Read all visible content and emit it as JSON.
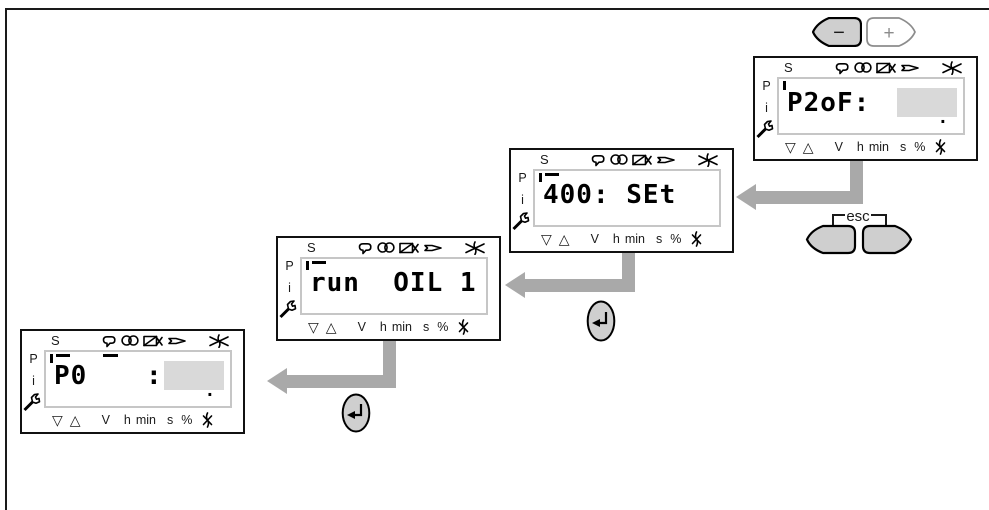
{
  "figure": {
    "kind": "lcd-menu-navigation-sequence"
  },
  "buttons": {
    "minus_label": "−",
    "plus_label": "+",
    "esc_label": "esc",
    "enter_icon_name": "enter-arrow-icon"
  },
  "panel_common": {
    "s_label": "S",
    "p_label": "P",
    "i_label": "i",
    "top_icon_names": [
      "reset-loop-icon",
      "fan-icon",
      "valve-icon",
      "burner-nozzle-icon",
      "flame-off-icon"
    ],
    "left_icon_name": "wrench-icon",
    "bottom_labels": [
      "▽",
      "△",
      "V",
      "h",
      "min",
      "s",
      "%"
    ],
    "bottom_icon_name": "flame-crossed-icon"
  },
  "panels": [
    {
      "name": "parameter-p2of",
      "display": "P2oF:",
      "display2": "",
      "value_box": true,
      "decimal_point": ".",
      "tick": true,
      "overbar": false,
      "overbar_after": false
    },
    {
      "name": "code-400-set",
      "display": "400: SEt",
      "display2": "",
      "value_box": false,
      "decimal_point": "",
      "tick": true,
      "overbar": true,
      "overbar_after": false
    },
    {
      "name": "run-oil-1",
      "display": "run  OIL 1",
      "display2": "",
      "value_box": false,
      "decimal_point": "",
      "tick": true,
      "overbar": true,
      "overbar_after": false
    },
    {
      "name": "parameter-p0",
      "display": "P0",
      "display2": ":",
      "value_box": true,
      "decimal_point": ".",
      "tick": true,
      "overbar": true,
      "overbar_after": true
    }
  ],
  "colors": {
    "button_gray": "#cfcfcf",
    "arrow_gray": "#a9a9a9",
    "value_box_gray": "#d9d9d9",
    "lcd_border_gray": "#c6c6c6"
  }
}
